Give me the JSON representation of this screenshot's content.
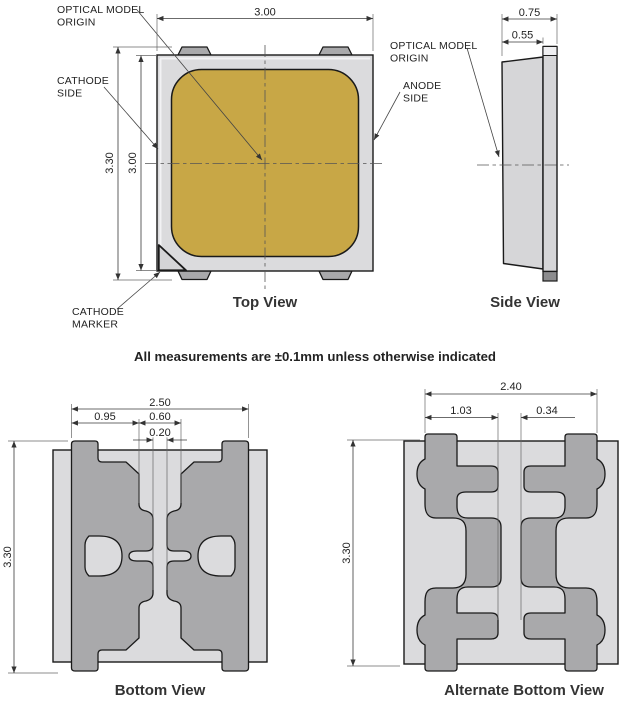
{
  "note": "All measurements are ±0.1mm unless otherwise indicated",
  "colors": {
    "gold": "#C8A746",
    "substrate": "#DBDBDD",
    "pad": "#A9A9AB",
    "pad_dark": "#8C8C8E",
    "outline": "#1A1A1A",
    "dim_line": "#3A3A3A"
  },
  "top_view": {
    "caption": "Top View",
    "dims": {
      "width": "3.00",
      "overall_height": "3.30",
      "body_height": "3.00"
    },
    "labels": {
      "optical_origin_1": "OPTICAL MODEL",
      "optical_origin_2": "ORIGIN",
      "cathode_side_1": "CATHODE",
      "cathode_side_2": "SIDE",
      "anode_side_1": "ANODE",
      "anode_side_2": "SIDE",
      "cathode_marker_1": "CATHODE",
      "cathode_marker_2": "MARKER"
    }
  },
  "side_view": {
    "caption": "Side View",
    "dims": {
      "total_depth": "0.75",
      "body_depth": "0.55"
    },
    "labels": {
      "optical_origin_1": "OPTICAL MODEL",
      "optical_origin_2": "ORIGIN"
    }
  },
  "bottom_view": {
    "caption": "Bottom View",
    "dims": {
      "pad_span": "2.50",
      "pad_width": "0.95",
      "center_span": "0.60",
      "center_gap": "0.20",
      "height": "3.30"
    }
  },
  "alt_bottom_view": {
    "caption": "Alternate Bottom View",
    "dims": {
      "pad_span": "2.40",
      "pad_width": "1.03",
      "center_gap": "0.34",
      "height": "3.30"
    }
  }
}
